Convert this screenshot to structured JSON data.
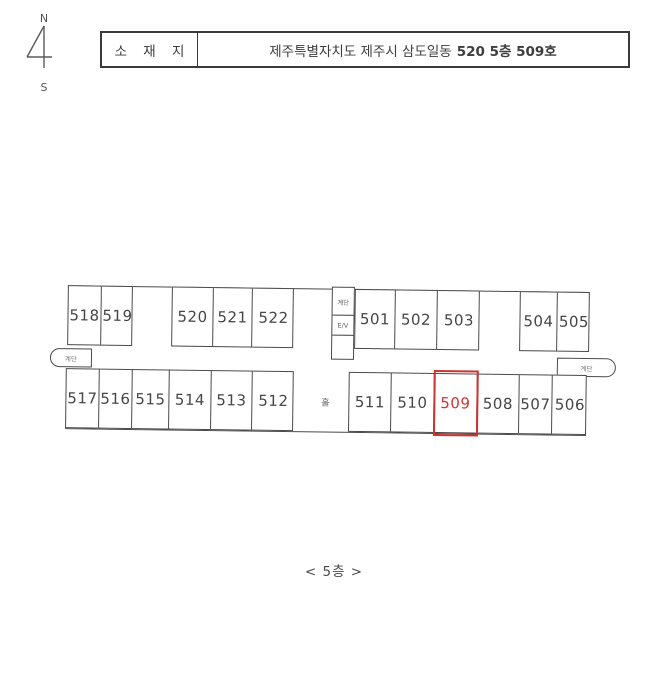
{
  "compass": {
    "north": "N",
    "south": "S"
  },
  "header": {
    "label": "소 재 지",
    "address_prefix": "제주특별자치도 제주시 삼도일동",
    "address_bold": "520 5층 509호"
  },
  "floor_plan": {
    "top_row": {
      "block1": [
        "518",
        "519"
      ],
      "block2": [
        "520",
        "521",
        "522"
      ],
      "core": {
        "stairs": "계단",
        "elevator": "E/V"
      },
      "block3": [
        "501",
        "502",
        "503"
      ],
      "block4": [
        "504",
        "505"
      ]
    },
    "bottom_row": {
      "block1": [
        "517",
        "516",
        "515",
        "514",
        "513",
        "512"
      ],
      "hall": "홀",
      "block2": [
        "511",
        "510",
        "509",
        "508",
        "507",
        "506"
      ]
    },
    "left_stairs": "계단",
    "right_stairs": "계단",
    "highlighted_room": "509"
  },
  "footer": {
    "floor_label": "< 5층 >"
  },
  "colors": {
    "line": "#4a4a4a",
    "highlight": "#cf3330"
  }
}
